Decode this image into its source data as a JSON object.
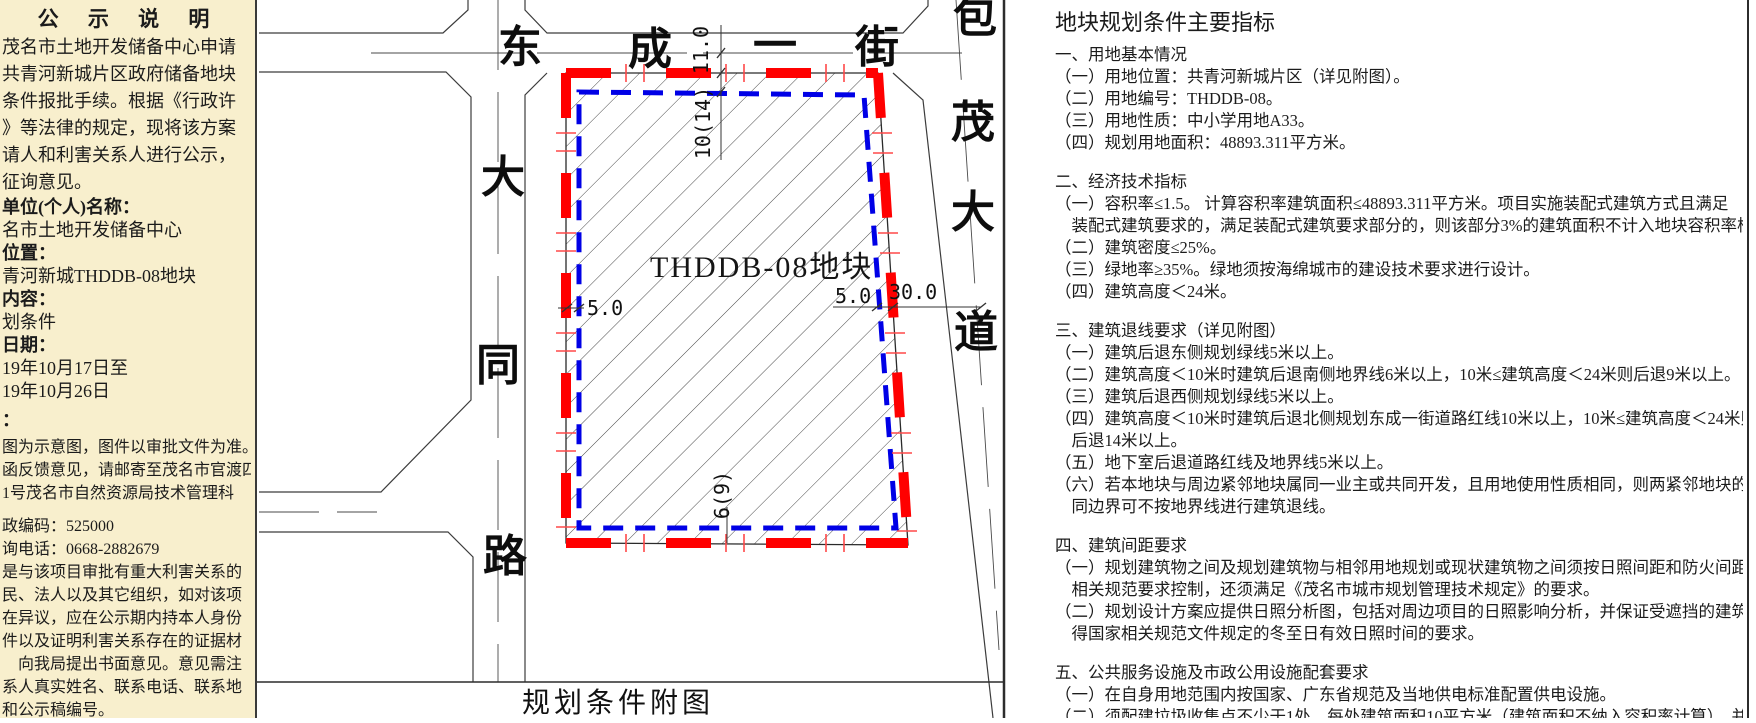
{
  "left_panel": {
    "title": "公 示 说 明",
    "lines": [
      "茂名市土地开发储备中心申请",
      "共青河新城片区政府储备地块",
      "条件报批手续。根据《行政许",
      "》等法律的规定，现将该方案",
      "请人和利害关系人进行公示，",
      "征询意见。",
      "单位(个人)名称：",
      "名市土地开发储备中心",
      "位置：",
      "青河新城THDDB-08地块",
      "内容：",
      "划条件",
      "日期：",
      "19年10月17日至",
      "19年10月26日",
      "：",
      "图为示意图，图件以审批文件为准。",
      "函反馈意见，请邮寄至茂名市官渡四",
      "1号茂名市自然资源局技术管理科",
      "政编码：525000",
      "询电话：0668-2882679",
      "是与该项目审批有重大利害关系的",
      "民、法人以及其它组织，如对该项",
      "在异议，应在公示期内持本人身份",
      "件以及证明利害关系存在的证据材",
      "　向我局提出书面意见。意见需注",
      "系人真实姓名、联系电话、联系地",
      "和公示稿编号。"
    ]
  },
  "map": {
    "plot_label": "THDDB-08地块",
    "caption": "规划条件附图",
    "street_north_chars": [
      "东",
      "成",
      "一",
      "街"
    ],
    "road_west_chars": [
      "大",
      "同",
      "路"
    ],
    "road_east_chars": [
      "包",
      "茂",
      "大",
      "道"
    ],
    "dims": {
      "north_road_halfwidth": "11.0",
      "north_setback": "10(14)",
      "west_setback": "5.0",
      "east_setback": "5.0",
      "east_road_halfwidth": "30.0",
      "south_setback": "6(9)"
    },
    "colors": {
      "boundary_red_line": "#ff0000",
      "building_setback_blue": "#0000e6"
    }
  },
  "right_panel": {
    "title": "地块规划条件主要指标",
    "lines": [
      "一、用地基本情况",
      "（一）用地位置：共青河新城片区（详见附图）。",
      "（二）用地编号：THDDB-08。",
      "（三）用地性质：中小学用地A33。",
      "（四）规划用地面积：48893.311平方米。",
      "",
      "二、经济技术指标",
      "（一）容积率≤1.5。 计算容积率建筑面积≤48893.311平方米。项目实施装配式建筑方式且满足",
      "　装配式建筑要求的，满足装配式建筑要求部分的，则该部分3%的建筑面积不计入地块容积率核算。",
      "（二）建筑密度≤25%。",
      "（三）绿地率≥35%。绿地须按海绵城市的建设技术要求进行设计。",
      "（四）建筑高度＜24米。",
      "",
      "三、建筑退线要求（详见附图）",
      "（一）建筑后退东侧规划绿线5米以上。",
      "（二）建筑高度＜10米时建筑后退南侧地界线6米以上，10米≤建筑高度＜24米则后退9米以上。",
      "（三）建筑后退西侧规划绿线5米以上。",
      "（四）建筑高度＜10米时建筑后退北侧规划东成一街道路红线10米以上，10米≤建筑高度＜24米则",
      "　后退14米以上。",
      "（五）地下室后退道路红线及地界线5米以上。",
      "（六）若本地块与周边紧邻地块属同一业主或共同开发，且用地使用性质相同，则两紧邻地块的共",
      "　同边界可不按地界线进行建筑退线。",
      "",
      "四、建筑间距要求",
      "（一）规划建筑物之间及规划建筑物与相邻用地规划或现状建筑物之间须按日照间距和防火间距的",
      "　相关规范要求控制，还须满足《茂名市城市规划管理技术规定》的要求。",
      "（二）规划设计方案应提供日照分析图，包括对周边项目的日照影响分析，并保证受遮挡的建筑获",
      "　得国家相关规范文件规定的冬至日有效日照时间的要求。",
      "",
      "五、公共服务设施及市政公用设施配套要求",
      "（一）在自身用地范围内按国家、广东省规范及当地供电标准配置供电设施。",
      "（二）须配建垃圾收集点不少于1处，每处建筑面积10平方米（建筑面积不纳入容积率计算），并"
    ]
  }
}
